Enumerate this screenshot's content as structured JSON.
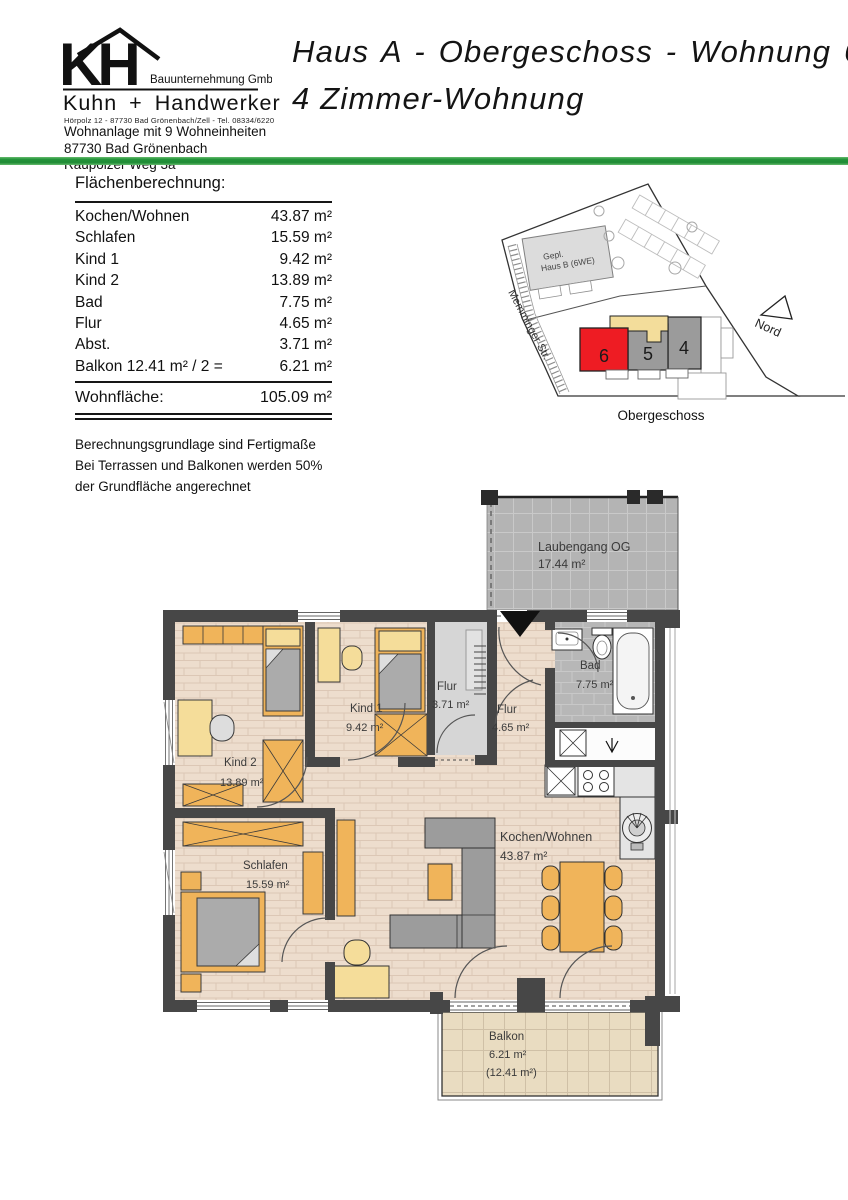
{
  "letterhead": {
    "logo_monogram": "KH",
    "company_type": "Bauunternehmung GmbH",
    "company_name": "Kuhn + Handwerker",
    "company_contact": "Hörpolz 12 - 87730 Bad Grönenbach/Zell - Tel. 08334/6220",
    "project_lines": [
      "Wohnanlage mit 9 Wohneinheiten",
      "87730 Bad Grönenbach",
      "Raupolzer Weg 3a"
    ]
  },
  "title": {
    "line1": "Haus A - Obergeschoss - Wohnung 6",
    "line2": "4 Zimmer-Wohnung"
  },
  "accent_green": "#23933a",
  "area_table": {
    "heading": "Flächenberechnung:",
    "rows": [
      {
        "label": "Kochen/Wohnen",
        "value": "43.87 m²"
      },
      {
        "label": "Schlafen",
        "value": "15.59 m²"
      },
      {
        "label": "Kind 1",
        "value": "9.42 m²"
      },
      {
        "label": "Kind 2",
        "value": "13.89 m²"
      },
      {
        "label": "Bad",
        "value": "7.75 m²"
      },
      {
        "label": "Flur",
        "value": "4.65 m²"
      },
      {
        "label": "Abst.",
        "value": "3.71 m²"
      },
      {
        "label": "Balkon 12.41 m² / 2 =",
        "value": "6.21 m²"
      }
    ],
    "total_label": "Wohnfläche:",
    "total_value": "105.09 m²",
    "notes": [
      "Berechnungsgrundlage sind Fertigmaße",
      "Bei Terrassen und Balkonen werden 50%",
      "der Grundfläche angerechnet"
    ]
  },
  "site_plan": {
    "building_b_line1": "Gepl.",
    "building_b_line2": "Haus B (6WE)",
    "street_label": "Memminger Str.",
    "north_label": "Nord",
    "caption": "Obergeschoss",
    "units": [
      "6",
      "5",
      "4"
    ],
    "highlight_color": "#ee1c23",
    "unit_gray": "#9b9b9b"
  },
  "floor_plan": {
    "rooms": {
      "laubengang": {
        "name": "Laubengang OG",
        "area": "17.44 m²"
      },
      "bad": {
        "name": "Bad",
        "area": "7.75 m²"
      },
      "flur_klein": {
        "name": "Flur",
        "area": "3.71 m²"
      },
      "flur": {
        "name": "Flur",
        "area": "4.65 m²"
      },
      "kind1": {
        "name": "Kind 1",
        "area": "9.42 m²"
      },
      "kind2": {
        "name": "Kind 2",
        "area": "13.89 m²"
      },
      "schlafen": {
        "name": "Schlafen",
        "area": "15.59 m²"
      },
      "kochen_wohnen": {
        "name": "Kochen/Wohnen",
        "area": "43.87 m²"
      },
      "balkon": {
        "name": "Balkon",
        "area": "6.21 m²",
        "area_full": "(12.41 m²)"
      }
    },
    "colors": {
      "wall": "#474747",
      "floor_beige": "#edddcd",
      "tile_gray": "#b4b4b4",
      "furniture_orange": "#f0b45a",
      "furniture_yellow": "#f5dd9a",
      "furniture_sofa_gray": "#9c9c9c",
      "balcony_floor": "#e9dcc1"
    }
  }
}
